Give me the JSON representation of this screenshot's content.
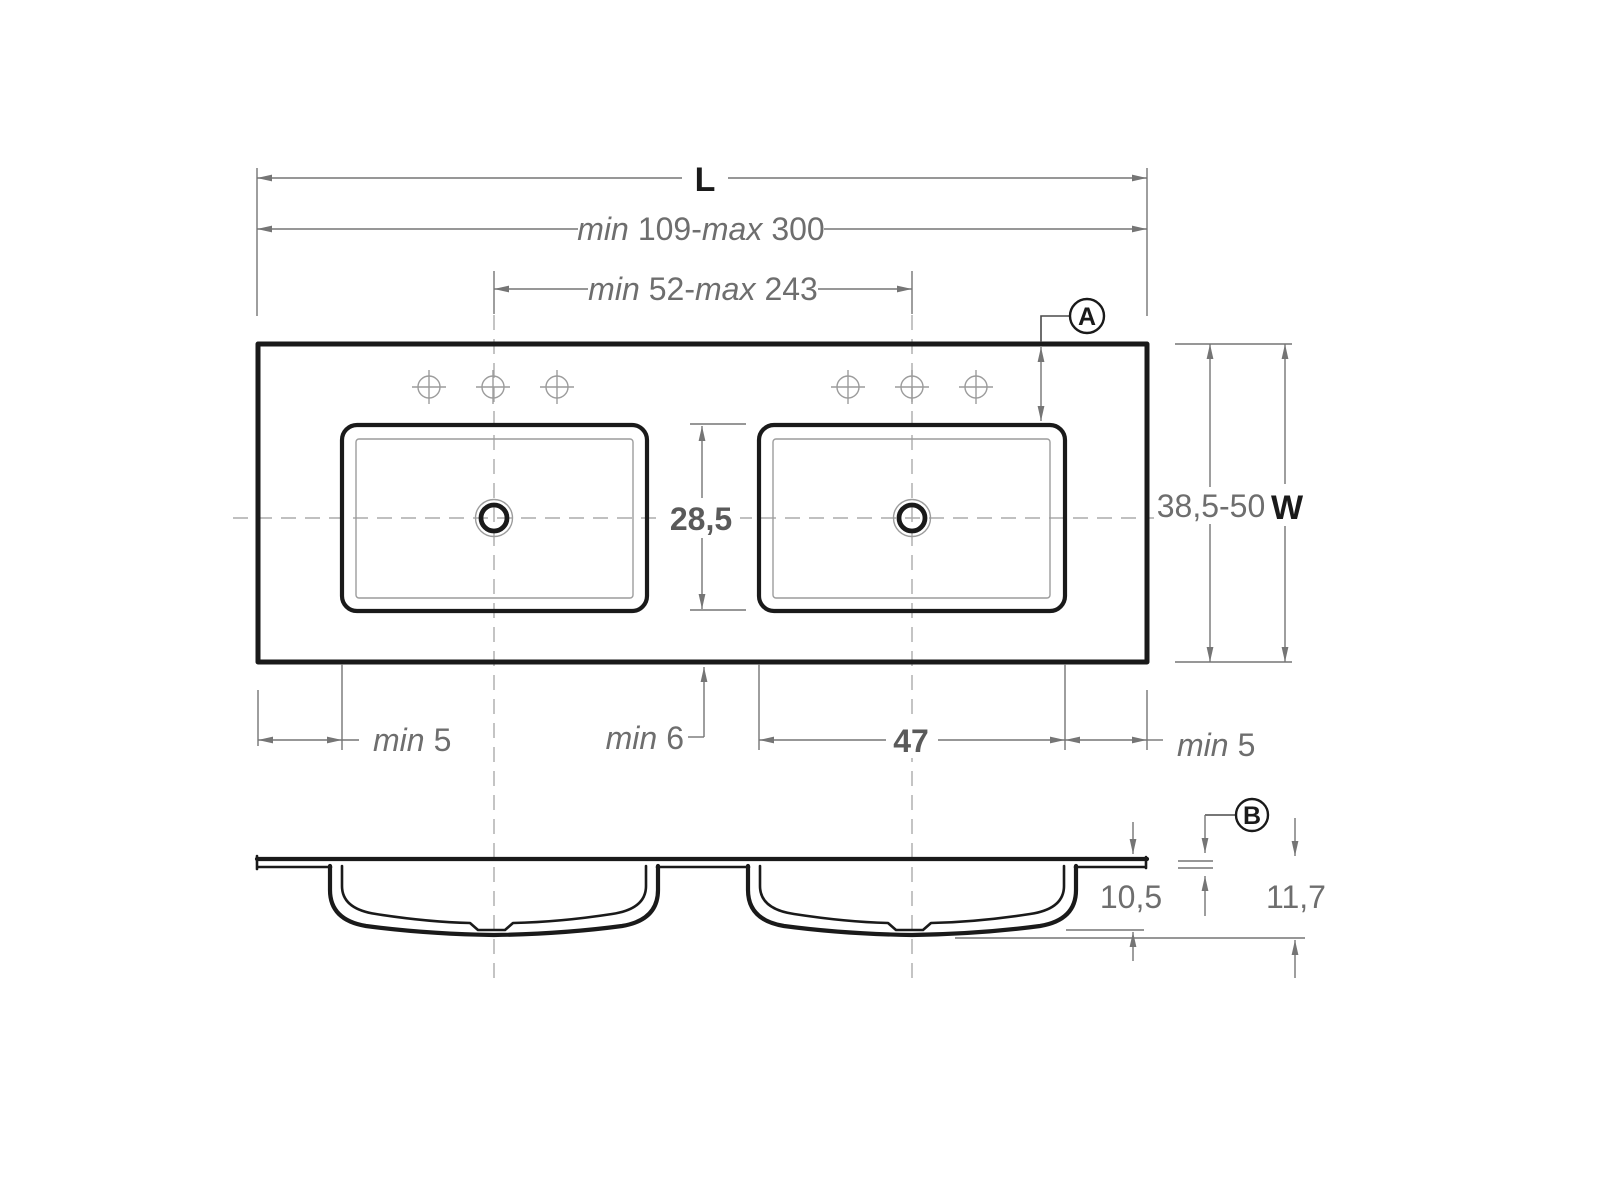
{
  "drawing": {
    "type": "dimensioned technical drawing",
    "subject": "double-basin washbasin countertop, plan view and section view",
    "units_style": "decimal comma"
  },
  "plan": {
    "overall_length": {
      "label": "L"
    },
    "length_range": {
      "min_word": "min",
      "min_value": "109",
      "separator": "-",
      "max_word": "max",
      "max_value": "300"
    },
    "centers_range": {
      "min_word": "min",
      "min_value": "52",
      "separator": "-",
      "max_word": "max",
      "max_value": "243"
    },
    "width_range": "38,5-50",
    "overall_width": {
      "label": "W"
    },
    "basin_inner_width": "28,5",
    "basin_inner_length": "47",
    "left_margin": {
      "word": "min",
      "value": "5"
    },
    "front_margin": {
      "word": "min",
      "value": "6"
    },
    "right_margin": {
      "word": "min",
      "value": "5"
    },
    "detail_a": "A"
  },
  "section": {
    "inner_depth": "10,5",
    "total_depth": "11,7",
    "detail_b": "B"
  },
  "icons": {
    "faucet_hole": "circle-with-crosshair",
    "drain": "concentric-rings",
    "centerline": "dashed-line"
  },
  "colors": {
    "outline": "#1a1a1a",
    "thin": "#9c9c9c",
    "dash": "#ababab",
    "dim": "#757575",
    "dim-text": "#6e6e6e",
    "dim-bold-text": "#5a5a5a",
    "label-text": "#1a1a1a",
    "bg": "#ffffff"
  }
}
